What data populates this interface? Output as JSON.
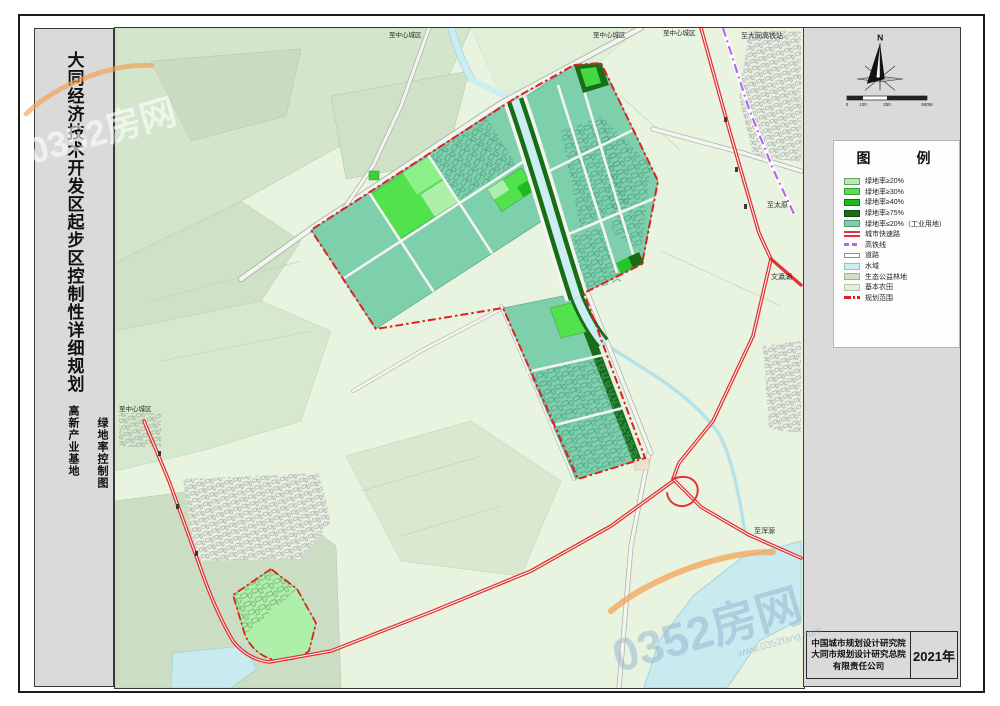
{
  "sheet": {
    "main_title": "大同经济技术开发区起步区控制性详细规划",
    "subtitle_left": "高新产业基地",
    "subtitle_right": "绿地率控制图"
  },
  "north": {
    "label": "N"
  },
  "scalebar": {
    "ticks": [
      "0",
      "100",
      "250",
      "500M"
    ]
  },
  "legend": {
    "title": "图　　例",
    "items": [
      {
        "label": "绿地率≥20%",
        "swatch_style": "background:#aef0aa;border:1px solid #6a9c68"
      },
      {
        "label": "绿地率≥30%",
        "swatch_style": "background:#52e24e;border:1px solid #3f9c3d"
      },
      {
        "label": "绿地率≥40%",
        "swatch_style": "background:#1fba1f;border:1px solid #157815"
      },
      {
        "label": "绿地率≥75%",
        "swatch_style": "background:#176e17;border:1px solid #0d4d0d"
      },
      {
        "label": "绿地率≤20%（工业用地）",
        "swatch_style": "background:#7ecfab;border:1px solid #4f9a7c"
      },
      {
        "label": "城市快速路",
        "swatch_style": "height:6px;border:none;background:linear-gradient(180deg,#e23333 0 2px,#ffffff 2px 4px,#e23333 4px 6px)"
      },
      {
        "label": "高铁线",
        "swatch_style": "height:3px;border:none;background:repeating-linear-gradient(90deg,#b469e6 0 5px,#ffffff 5px 8px)"
      },
      {
        "label": "道路",
        "swatch_style": "height:5px;background:#ffffff;border:1px solid #8a948a"
      },
      {
        "label": "水域",
        "swatch_style": "background:#cceef2;border:1px solid #8fc3cc"
      },
      {
        "label": "生态公益林地",
        "swatch_style": "background:#cddfc5;border:1px solid #9ab190"
      },
      {
        "label": "基本农田",
        "swatch_style": "background:#e3f0d9;border:1px solid #b3c5a6"
      },
      {
        "label": "规划范围",
        "swatch_style": "height:3px;border:none;background:repeating-linear-gradient(90deg,#e01f1f 0 7px,transparent 7px 9px,#e01f1f 9px 11px,transparent 11px 13px)"
      }
    ]
  },
  "map_labels": [
    {
      "text": "至中心城区"
    },
    {
      "text": "至中心城区"
    },
    {
      "text": "至中心城区"
    },
    {
      "text": "至大同高铁站"
    },
    {
      "text": "至太原"
    },
    {
      "text": "文瀛湖"
    },
    {
      "text": "至浑源"
    },
    {
      "text": "至中心城区"
    }
  ],
  "attribution": {
    "line1": "中国城市规划设计研究院",
    "line2": "大同市规划设计研究总院",
    "line3": "有限责任公司",
    "year": "2021年"
  },
  "watermark": {
    "brand": "0352房网",
    "site": "www.0352fang.com"
  },
  "colors": {
    "green_20": "#aef0aa",
    "green_30": "#52e24e",
    "green_40": "#1fba1f",
    "green_75": "#176e17",
    "industrial_teal": "#7ecfab",
    "expressway_red": "#e23333",
    "hsr_purple": "#b469e6",
    "water_blue": "#cceef2",
    "forest_gray_green": "#cddfc5",
    "farmland_pale": "#e3f0d9",
    "boundary_red": "#e01f1f"
  }
}
